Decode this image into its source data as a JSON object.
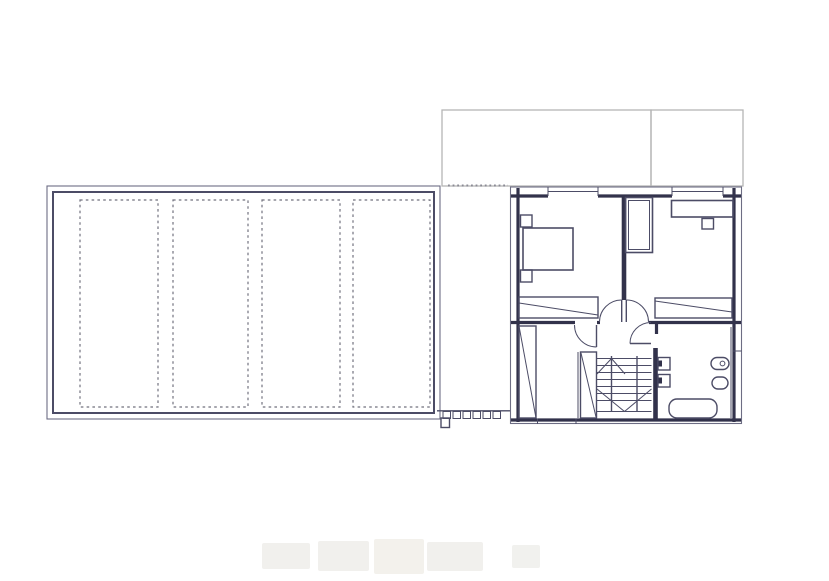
{
  "document": {
    "kind": "architectural-floor-plan-drawing",
    "visible_text": [],
    "background": "#ffffff"
  },
  "colors": {
    "wall_dark": "#32324b",
    "line_mid": "#4c4c66",
    "line_thin": "#6d6d84",
    "roof_gray": "#b5b5b5",
    "dash_gray": "#72727e",
    "watermark_gray": "#f0efec"
  },
  "garage_roof_plan": {
    "skylight_panel_count": 4,
    "border_style": "double-line",
    "panel_line_style": "dashed"
  },
  "adjacent_roof_outlines": {
    "count": 2,
    "style": "light-gray-outline"
  },
  "connectors": {
    "top_dotted_line": true,
    "pergola_post_count": 6,
    "corner_post_count": 1
  },
  "floor_plan": {
    "window_count": 3,
    "door_symbols": [
      "double-swing-door",
      "left-room-door",
      "bathroom-door"
    ],
    "fixture_icons": [
      "bed-icon",
      "nightstand-icon",
      "nightstand-icon",
      "wardrobe-icon",
      "desk-icon",
      "chair-icon",
      "closet-diagonal-icon",
      "closet-diagonal-icon",
      "wardrobe-band-icon",
      "wardrobe-band-icon",
      "radiator-icon",
      "radiator-icon",
      "toilet-icon",
      "bidet-icon",
      "bathtub-icon",
      "staircase-icon"
    ],
    "staircase": {
      "tread_count": 6,
      "flights": 3,
      "winder_fan_lines": 6
    }
  },
  "watermark": {
    "blob_count": 5
  }
}
